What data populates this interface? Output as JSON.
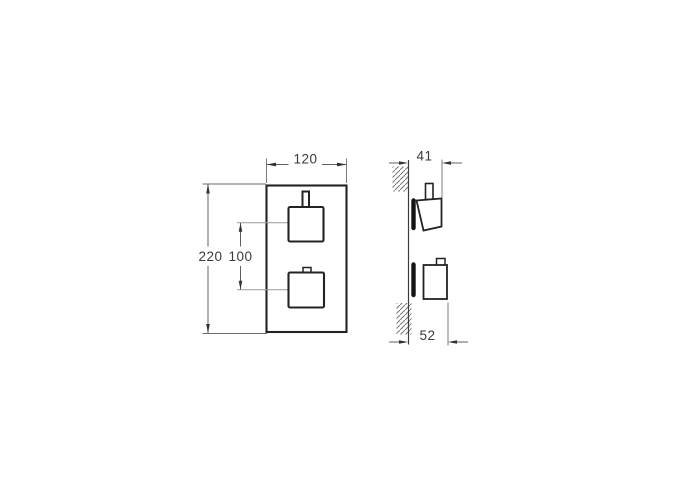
{
  "drawing": {
    "type": "technical-installation-drawing",
    "subject": "thermostatic-mixer-valve-two-square-handles",
    "views": {
      "front": "front-view-with-trim-plate-and-two-handles",
      "side": "side-profile-at-wall"
    },
    "dimensions": {
      "plate_width": "120",
      "plate_height": "220",
      "handle_spacing": "100",
      "upper_handle_projection": "41",
      "lower_handle_projection": "52"
    },
    "colors": {
      "background": "#ffffff",
      "object_line": "#232323",
      "dimension_line": "#606060",
      "center_line": "#9a9a9a",
      "solid_bar": "#141414",
      "text": "#3a3a3a"
    }
  }
}
